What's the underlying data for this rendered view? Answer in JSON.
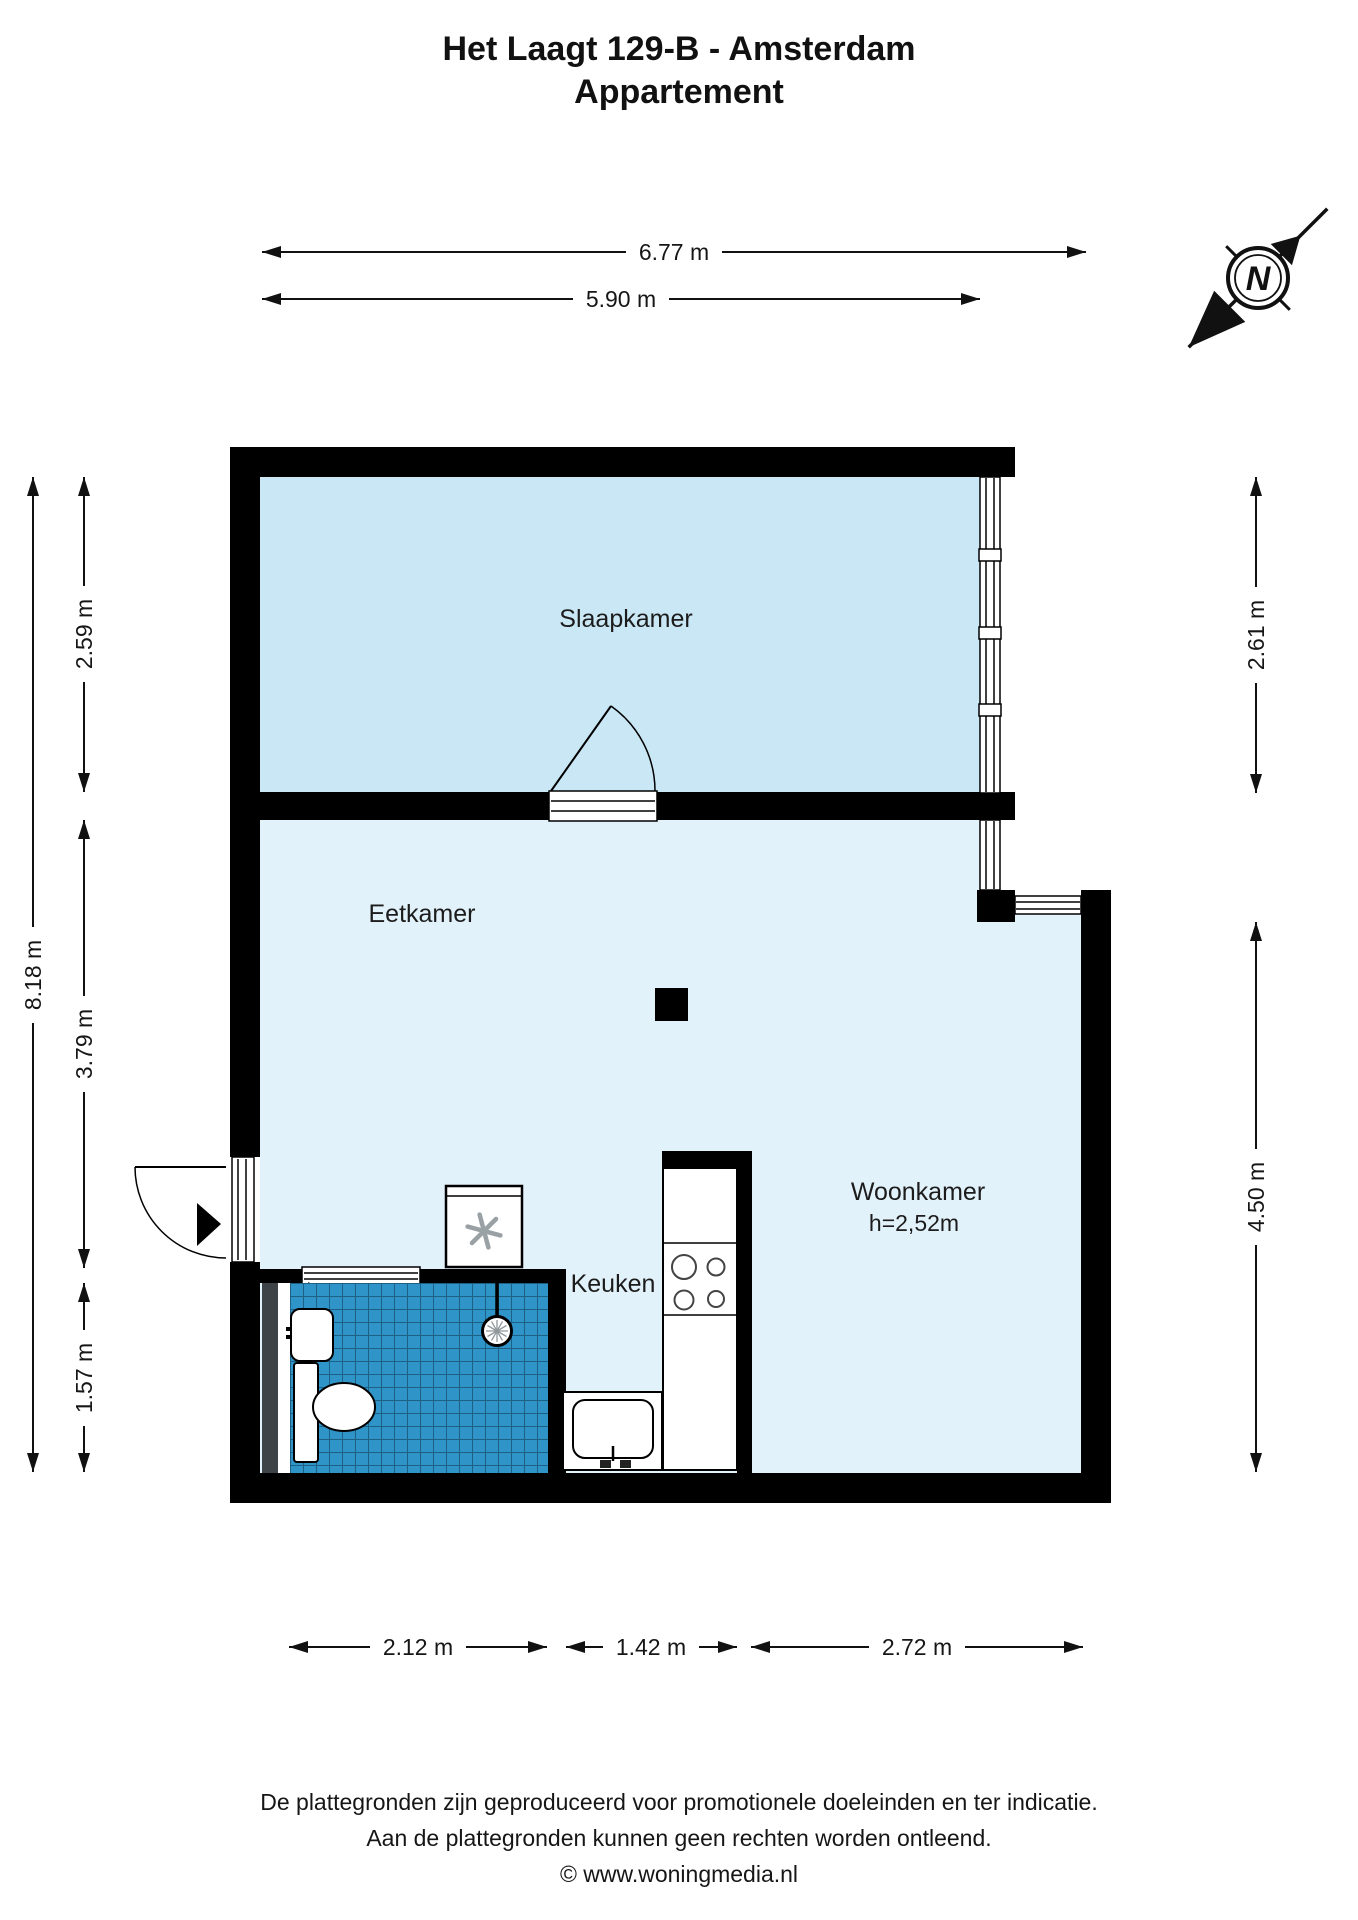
{
  "title": {
    "line1": "Het Laagt 129-B - Amsterdam",
    "line2": "Appartement"
  },
  "rooms": {
    "slaapkamer": {
      "label": "Slaapkamer"
    },
    "eetkamer": {
      "label": "Eetkamer"
    },
    "woonkamer": {
      "label": "Woonkamer",
      "ceiling_height": "h=2,52m"
    },
    "keuken": {
      "label": "Keuken"
    }
  },
  "dimensions": {
    "top": {
      "overall": "6.77 m",
      "bedroom_width": "5.90 m"
    },
    "left": {
      "overall": "8.18 m",
      "bedroom": "2.59 m",
      "dining": "3.79 m",
      "bathroom": "1.57 m"
    },
    "right": {
      "bedroom": "2.61 m",
      "living": "4.50 m"
    },
    "bottom": {
      "bathroom": "2.12 m",
      "kitchen": "1.42 m",
      "living": "2.72 m"
    }
  },
  "compass": {
    "north_label": "N"
  },
  "footer": {
    "line1": "De plattegronden zijn geproduceerd voor promotionele doeleinden en ter indicatie.",
    "line2": "Aan de plattegronden kunnen geen rechten worden ontleend.",
    "line3": "© www.woningmedia.nl"
  },
  "colors": {
    "wall": "#000000",
    "bedroom_floor": "#c9e7f5",
    "living_floor": "#e2f2fa",
    "bathroom_tile": "#2f95c9",
    "bathroom_tile_grout": "#1d5f85",
    "shaft_gray": "#3e4347"
  }
}
